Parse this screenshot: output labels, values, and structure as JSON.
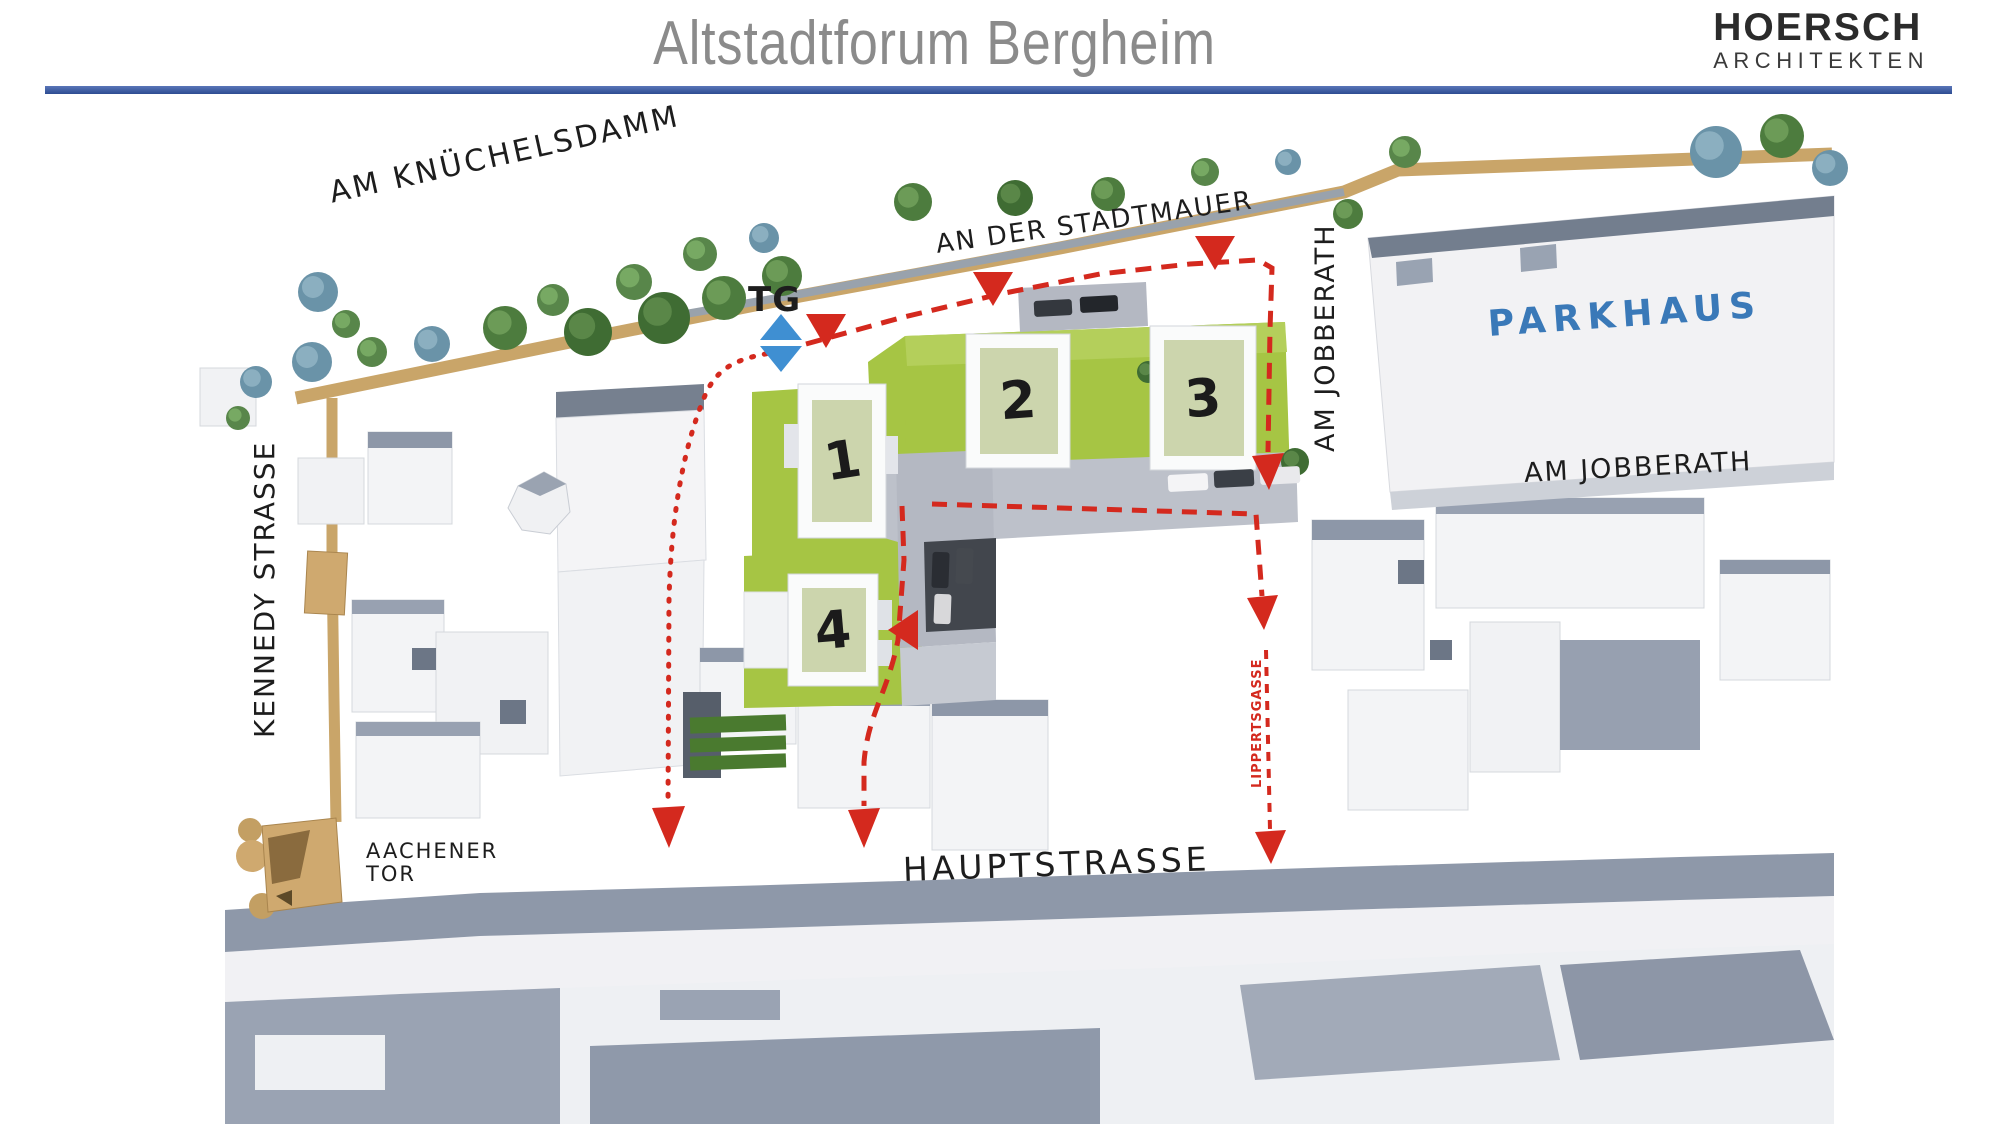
{
  "header": {
    "title": "Altstadtforum Bergheim",
    "logo_line1": "HOERSCH",
    "logo_line2": "ARCHITEKTEN"
  },
  "plan": {
    "street_labels": {
      "am_knuechelsdamm": "AM KNÜCHELSDAMM",
      "an_der_stadtmauer": "AN DER STADTMAUER",
      "am_jobberath_top": "AM JOBBERATH",
      "am_jobberath_right": "AM JOBBERATH",
      "kennedy_strasse": "KENNEDY STRASSE",
      "hauptstrasse": "HAUPTSTRASSE",
      "lippertsgasse": "LIPPERTSGASSE",
      "aachener_tor_line1": "AACHENER",
      "aachener_tor_line2": "TOR",
      "parkhaus": "PARKHAUS",
      "tg": "TG"
    },
    "buildings": {
      "b1": "1",
      "b2": "2",
      "b3": "3",
      "b4": "4"
    },
    "markers": {
      "red_triangle": "site-entrance-marker",
      "blue_double_triangle": "underground-garage-access-marker",
      "red_dashed_line": "pedestrian-route"
    },
    "colors": {
      "rule_blue": "#3d5fa9",
      "title_gray": "#8b8b8b",
      "accent_red": "#d4291e",
      "marker_blue": "#3f8fd2",
      "parkhaus_label_blue": "#3a79b8",
      "lawn_green": "#a6c544",
      "roof_sage": "#ccd5ad",
      "road_tan": "#c9a569",
      "roof_slate": "#8e98a9"
    }
  }
}
